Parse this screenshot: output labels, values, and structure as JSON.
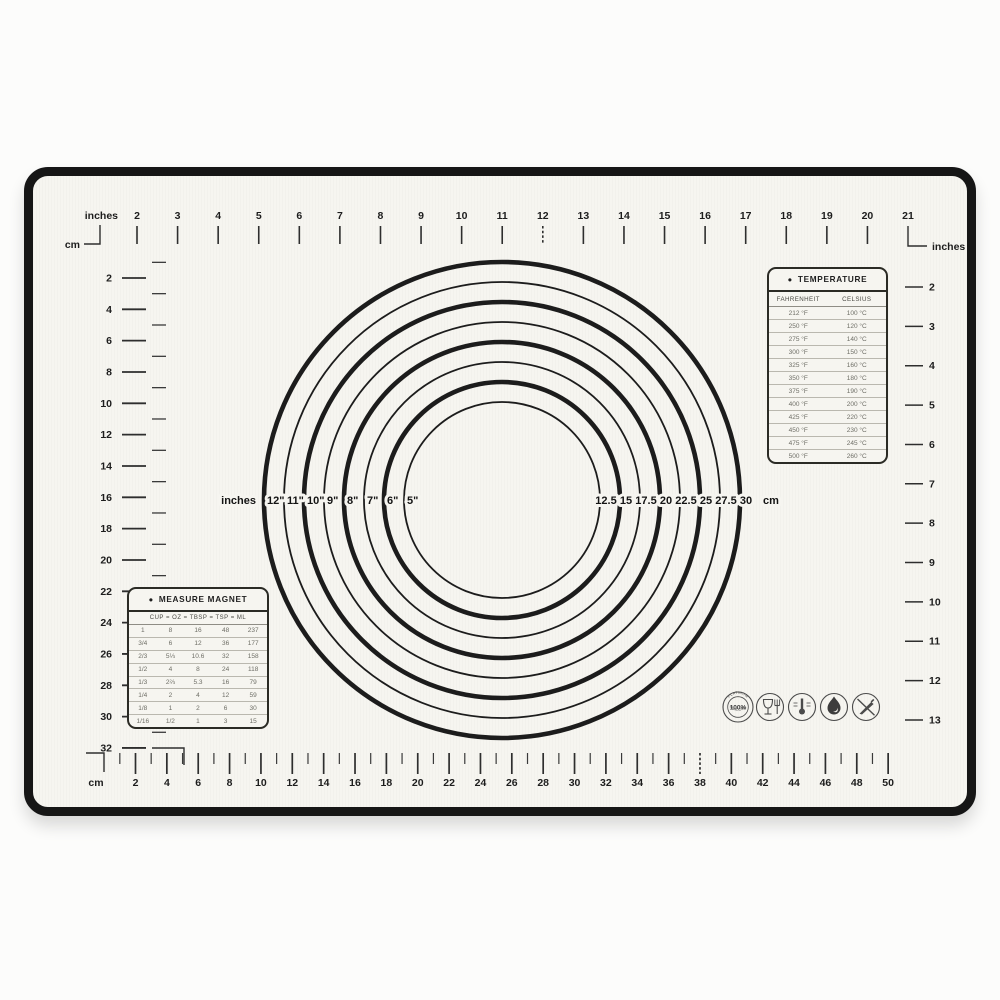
{
  "colors": {
    "mat_surface": "#f6f5f0",
    "mat_border": "#161616",
    "ink": "#1d1d1d",
    "faint_ink": "#6e6e66"
  },
  "mat": {
    "rulers": {
      "top": {
        "unit": "inches",
        "values": [
          2,
          3,
          4,
          5,
          6,
          7,
          8,
          9,
          10,
          11,
          12,
          13,
          14,
          15,
          16,
          17,
          18,
          19,
          20,
          21
        ]
      },
      "left": {
        "unit": "cm",
        "values": [
          2,
          4,
          6,
          8,
          10,
          12,
          14,
          16,
          18,
          20,
          22,
          24,
          26,
          28,
          30,
          32
        ]
      },
      "right": {
        "unit": "inches",
        "values": [
          2,
          3,
          4,
          5,
          6,
          7,
          8,
          9,
          10,
          11,
          12,
          13
        ]
      },
      "bottom": {
        "unit": "cm",
        "values": [
          2,
          4,
          6,
          8,
          10,
          12,
          14,
          16,
          18,
          20,
          22,
          24,
          26,
          28,
          30,
          32,
          34,
          36,
          38,
          40,
          42,
          44,
          46,
          48,
          50
        ]
      }
    },
    "circles": {
      "left_unit": "inches",
      "right_unit": "cm",
      "rings": [
        {
          "diameter_in": 12,
          "inches_label": "12\"",
          "cm_label": "30"
        },
        {
          "diameter_in": 11,
          "inches_label": "11\"",
          "cm_label": "27.5"
        },
        {
          "diameter_in": 10,
          "inches_label": "10\"",
          "cm_label": "25"
        },
        {
          "diameter_in": 9,
          "inches_label": "9\"",
          "cm_label": "22.5"
        },
        {
          "diameter_in": 8,
          "inches_label": "8\"",
          "cm_label": "20"
        },
        {
          "diameter_in": 7,
          "inches_label": "7\"",
          "cm_label": "17.5"
        },
        {
          "diameter_in": 6,
          "inches_label": "6\"",
          "cm_label": "15"
        },
        {
          "diameter_in": 5,
          "inches_label": "5\"",
          "cm_label": "12.5"
        }
      ]
    },
    "temperature_table": {
      "bullet": "●",
      "title": "TEMPERATURE",
      "columns": [
        "FAHRENHEIT",
        "CELSIUS"
      ],
      "rows": [
        [
          "212 °F",
          "100 °C"
        ],
        [
          "250 °F",
          "120 °C"
        ],
        [
          "275 °F",
          "140 °C"
        ],
        [
          "300 °F",
          "150 °C"
        ],
        [
          "325 °F",
          "160 °C"
        ],
        [
          "350 °F",
          "180 °C"
        ],
        [
          "375 °F",
          "190 °C"
        ],
        [
          "400 °F",
          "200 °C"
        ],
        [
          "425 °F",
          "220 °C"
        ],
        [
          "450 °F",
          "230 °C"
        ],
        [
          "475 °F",
          "245 °C"
        ],
        [
          "500 °F",
          "260 °C"
        ]
      ]
    },
    "measure_table": {
      "bullet": "●",
      "title": "MEASURE MAGNET",
      "header": "CUP = OZ = TBSP = TSP = ML",
      "rows": [
        [
          "1",
          "8",
          "16",
          "48",
          "237"
        ],
        [
          "3/4",
          "6",
          "12",
          "36",
          "177"
        ],
        [
          "2/3",
          "5⅓",
          "10.6",
          "32",
          "158"
        ],
        [
          "1/2",
          "4",
          "8",
          "24",
          "118"
        ],
        [
          "1/3",
          "2⅔",
          "5.3",
          "16",
          "79"
        ],
        [
          "1/4",
          "2",
          "4",
          "12",
          "59"
        ],
        [
          "1/8",
          "1",
          "2",
          "6",
          "30"
        ],
        [
          "1/16",
          "1/2",
          "1",
          "3",
          "15"
        ]
      ]
    },
    "badges": {
      "platinum": {
        "percent": "100%",
        "arc_top": "PLATINUM",
        "arc_bottom": "SILICONE"
      },
      "icons": [
        "platinum-silicone-badge",
        "food-safe-icon",
        "temperature-range-icon",
        "heat-resistant-icon",
        "no-knife-icon"
      ]
    }
  }
}
